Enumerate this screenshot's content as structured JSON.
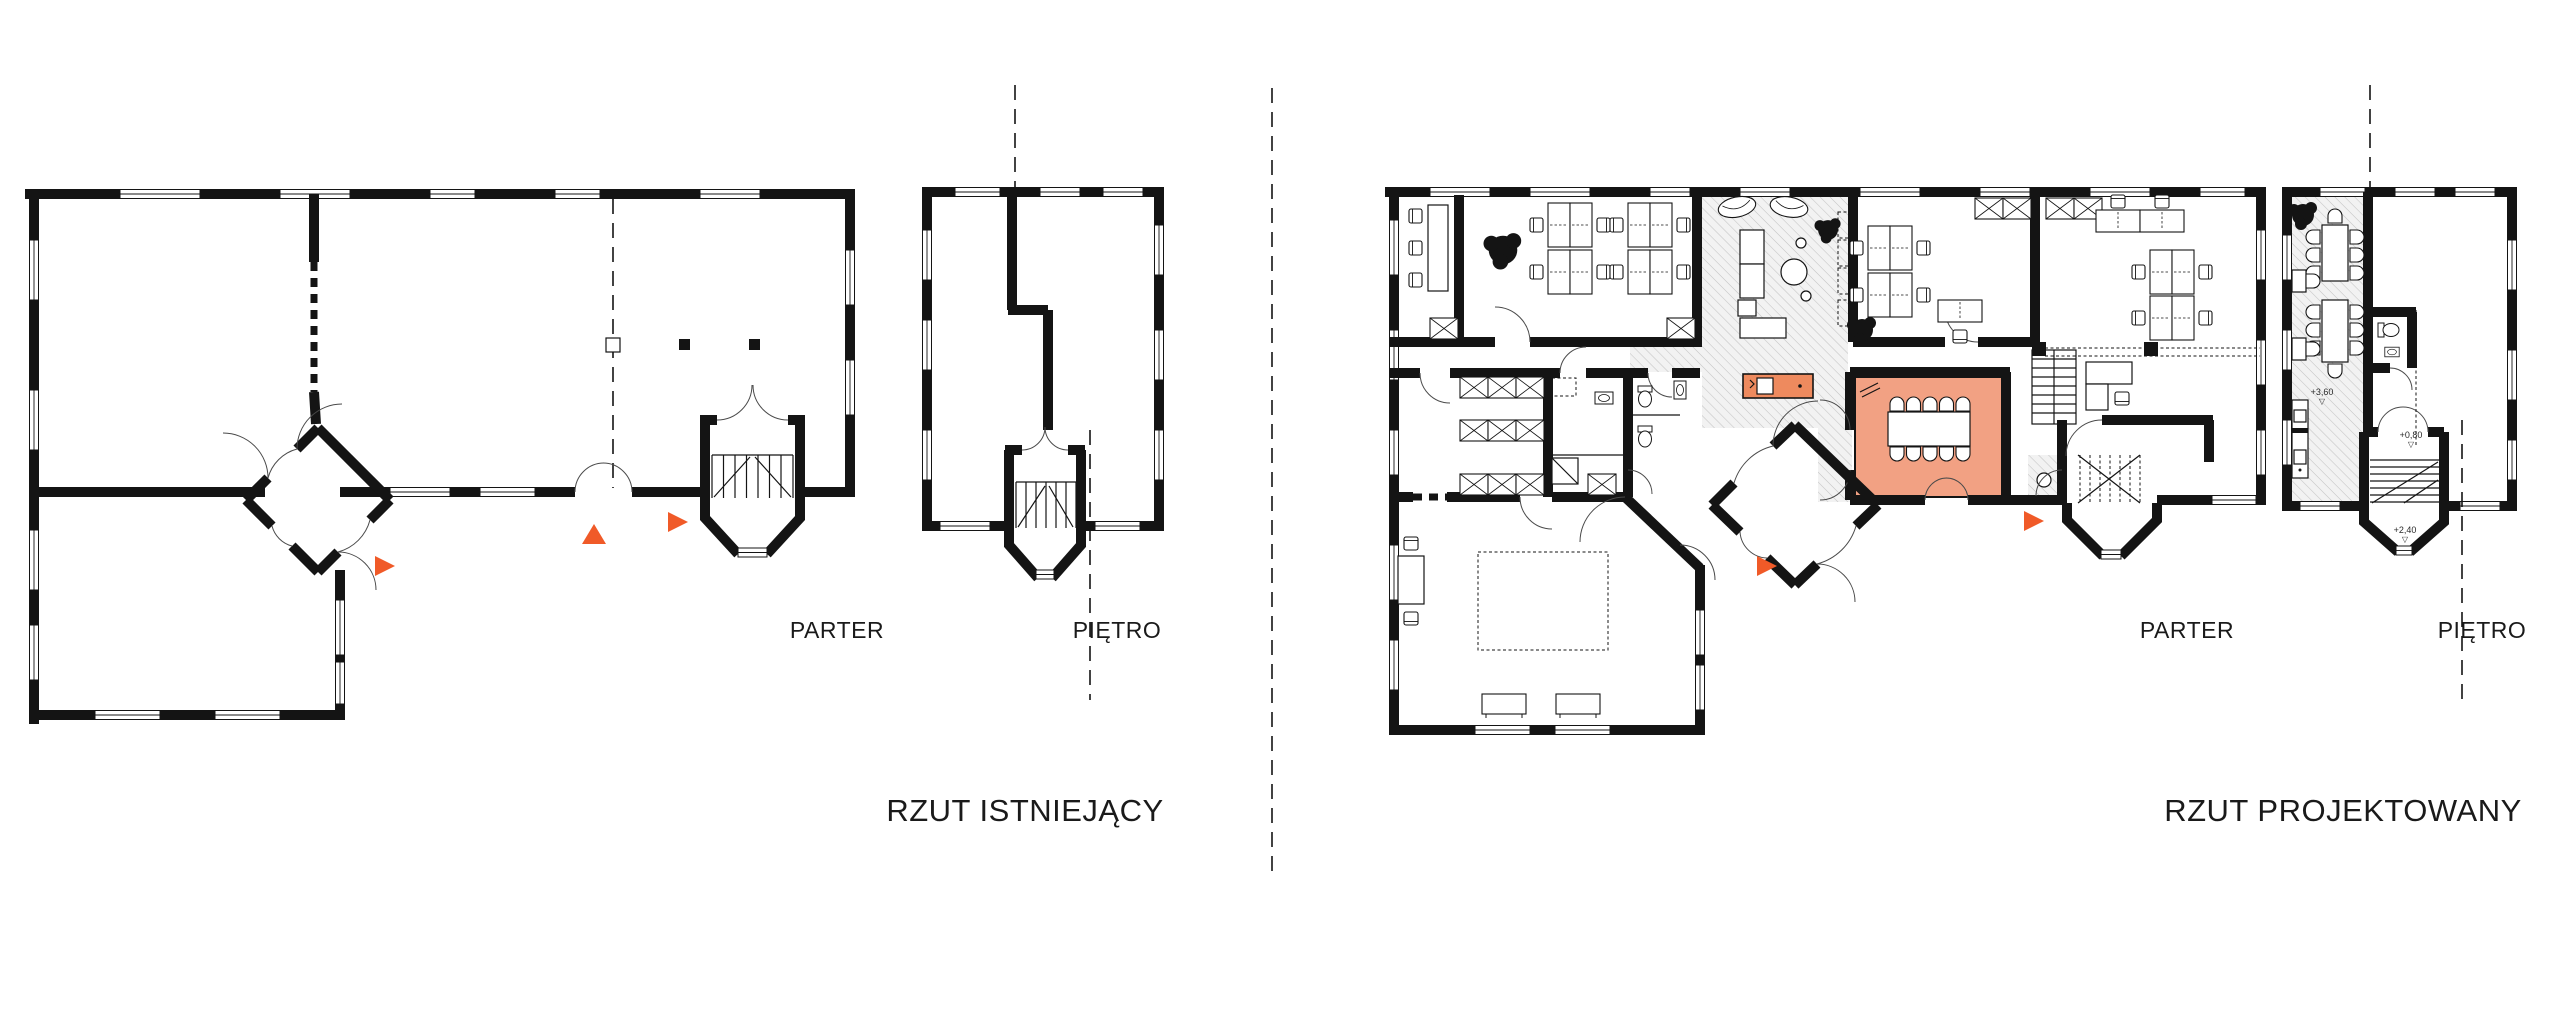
{
  "page": {
    "background": "#ffffff"
  },
  "colors": {
    "ink": "#1a1a1a",
    "accent": "#f05a28",
    "room_fill": "#f2a183",
    "kitchen_fill": "#ee8a5e",
    "hatch_line": "#c4c4c4",
    "hatch_bg": "#f2f2f2"
  },
  "left_plan": {
    "title": "RZUT ISTNIEJĄCY",
    "parter_label": "PARTER",
    "pietro_label": "PIĘTRO"
  },
  "right_plan": {
    "title": "RZUT PROJEKTOWANY",
    "parter_label": "PARTER",
    "pietro_label": "PIĘTRO",
    "levels": [
      {
        "value": "+3,60",
        "icon": "▽"
      },
      {
        "value": "+0,80",
        "icon": "▽"
      },
      {
        "value": "+2,40",
        "icon": "▽"
      }
    ]
  }
}
